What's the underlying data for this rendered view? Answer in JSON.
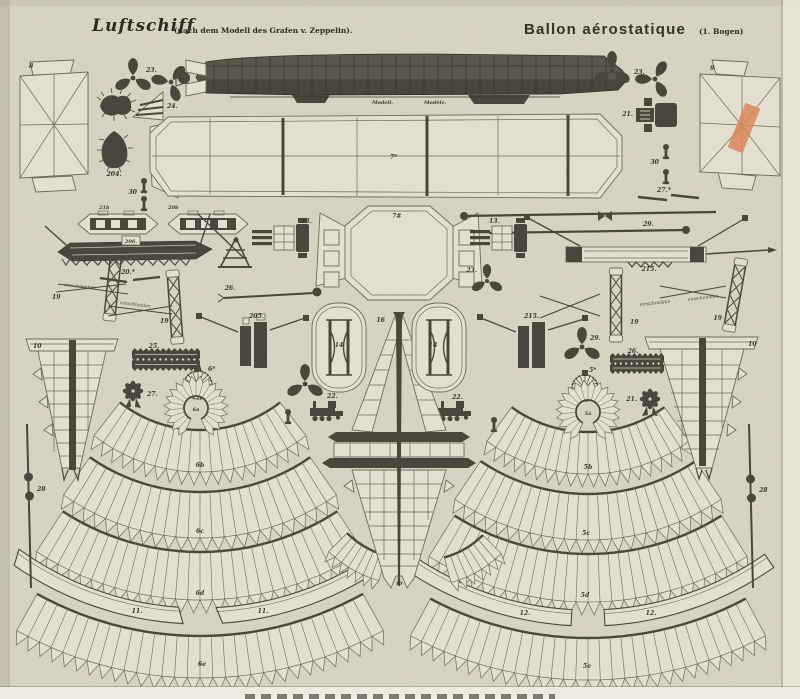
{
  "header": {
    "title_de": "Luftschiff",
    "subtitle_de": "(nach dem Modell des Grafen v. Zeppelin).",
    "title_fr": "Ballon aérostatique",
    "sheet_note": "(1. Bogen)"
  },
  "captions": {
    "model_de": "Modell.",
    "model_fr": "Modèle."
  },
  "annotations": {
    "einschneiden": "einschneiden"
  },
  "colors": {
    "paper": "#dbd6c6",
    "piece": "#e8e4d5",
    "line": "#6d6859",
    "ink": "#47433b",
    "tape": "#dd8757"
  },
  "labels": {
    "p8": "8",
    "p9": "9",
    "p23": "23.",
    "p24": "24.",
    "p204": "204.",
    "p30": "30",
    "p7star": "7*",
    "p7hash": "7#",
    "p21": "21.",
    "p27star": "27.*",
    "p21b": "21b",
    "p20b": "20b",
    "p206": "206.",
    "p13": "13.",
    "p29": "29.",
    "p215": "215.",
    "p205": "205.",
    "p19": "19",
    "p20star": "20.*",
    "p25": "25.",
    "p26": "26.",
    "p27": "27.",
    "p28": "28",
    "p14": "14",
    "p16": "16",
    "p10": "10",
    "p22": "22.",
    "p6star": "6*",
    "p5star": "5*",
    "p6a": "6a",
    "p6b": "6b",
    "p6c": "6c",
    "p6d": "6d",
    "p6e": "6e",
    "p5a": "5a",
    "p5b": "5b",
    "p5c": "5c",
    "p5d": "5d",
    "p5e": "5e",
    "p11": "11.",
    "p12": "12."
  }
}
